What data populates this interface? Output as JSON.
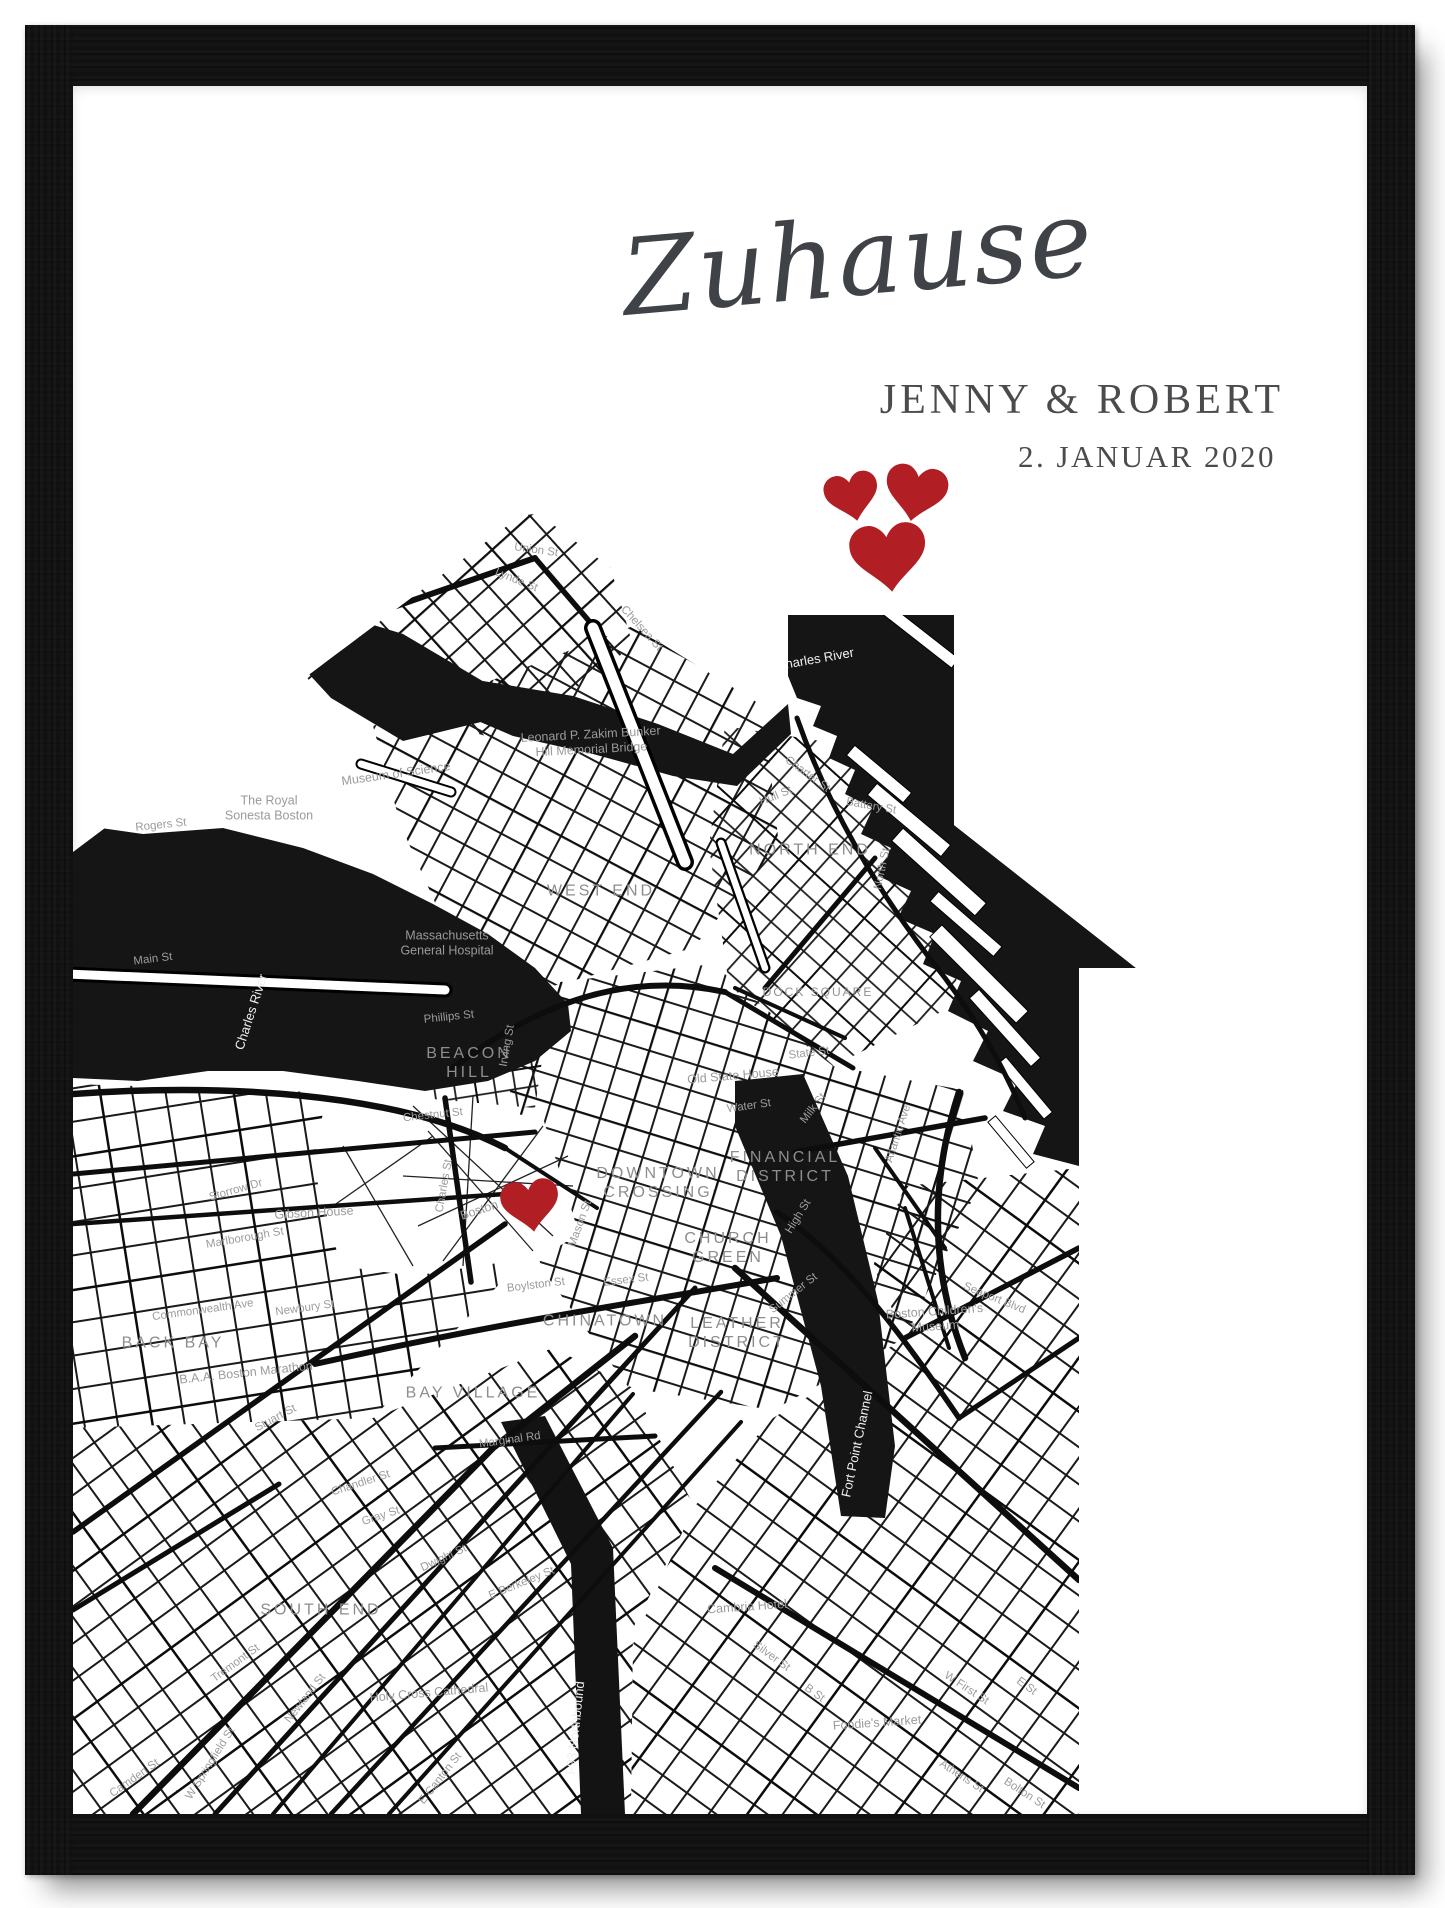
{
  "poster": {
    "title": "Zuhause",
    "names": "JENNY & ROBERT",
    "date": "2. JANUAR 2020"
  },
  "colors": {
    "heart_red": "#b11e24",
    "text_dark": "#4b4b4e",
    "title_gray": "#3f4246",
    "map_ink": "#141414",
    "label_gray": "#9a9a9a",
    "frame_black": "#121212"
  },
  "decor_hearts": [
    {
      "x": 780,
      "y": 412,
      "s": 54,
      "r": -12
    },
    {
      "x": 842,
      "y": 409,
      "s": 62,
      "r": 10
    },
    {
      "x": 816,
      "y": 473,
      "s": 76,
      "r": -6
    }
  ],
  "map": {
    "marker": {
      "x": 458,
      "y": 1121,
      "s": 58,
      "r": -8
    },
    "labels": [
      {
        "t": "NORTH END",
        "x": 737,
        "y": 765,
        "r": 0,
        "c": "nb"
      },
      {
        "t": "WEST END",
        "x": 528,
        "y": 806,
        "r": 0,
        "c": "nb"
      },
      {
        "t": "BEACON\nHILL",
        "x": 396,
        "y": 978,
        "r": 0,
        "c": "nb"
      },
      {
        "t": "DOWNTOWN\nCROSSING",
        "x": 585,
        "y": 1098,
        "r": 0,
        "c": "nb"
      },
      {
        "t": "FINANCIAL\nDISTRICT",
        "x": 712,
        "y": 1082,
        "r": 0,
        "c": "nb"
      },
      {
        "t": "CHURCH\nGREEN",
        "x": 655,
        "y": 1163,
        "r": 0,
        "c": "nb"
      },
      {
        "t": "CHINATOWN",
        "x": 532,
        "y": 1236,
        "r": 0,
        "c": "nb"
      },
      {
        "t": "LEATHER\nDISTRICT",
        "x": 664,
        "y": 1248,
        "r": 0,
        "c": "nb"
      },
      {
        "t": "BACK BAY",
        "x": 100,
        "y": 1258,
        "r": 0,
        "c": "nb"
      },
      {
        "t": "BAY VILLAGE",
        "x": 400,
        "y": 1308,
        "r": 0,
        "c": "nb"
      },
      {
        "t": "SOUTH END",
        "x": 248,
        "y": 1525,
        "r": 0,
        "c": "nb"
      },
      {
        "t": "DOCK SQUARE",
        "x": 745,
        "y": 906,
        "r": 0,
        "c": "nbs"
      },
      {
        "t": "Museum of Science",
        "x": 323,
        "y": 688,
        "r": -8,
        "c": "poi"
      },
      {
        "t": "The Royal\nSonesta Boston",
        "x": 196,
        "y": 722,
        "r": 0,
        "c": "poi"
      },
      {
        "t": "Massachusetts\nGeneral Hospital",
        "x": 374,
        "y": 857,
        "r": 0,
        "c": "poi"
      },
      {
        "t": "Leonard P. Zakim Bunker\nHill Memorial Bridge",
        "x": 518,
        "y": 656,
        "r": -3,
        "c": "poi"
      },
      {
        "t": "Old State House",
        "x": 660,
        "y": 990,
        "r": -5,
        "c": "poi"
      },
      {
        "t": "Gibson House",
        "x": 241,
        "y": 1127,
        "r": -3,
        "c": "poi"
      },
      {
        "t": "B.A.A. Boston Marathon",
        "x": 173,
        "y": 1287,
        "r": -6,
        "c": "poi"
      },
      {
        "t": "Boston Common",
        "x": 432,
        "y": 1116,
        "r": -18,
        "c": "poi"
      },
      {
        "t": "Holy Cross Cathedral",
        "x": 356,
        "y": 1607,
        "r": -5,
        "c": "poi"
      },
      {
        "t": "Cambria Hotel",
        "x": 674,
        "y": 1521,
        "r": -4,
        "c": "poi"
      },
      {
        "t": "Foodie's Market",
        "x": 804,
        "y": 1637,
        "r": -4,
        "c": "poi"
      },
      {
        "t": "Boston Children's\nMuseum",
        "x": 862,
        "y": 1233,
        "r": -4,
        "c": "poi"
      },
      {
        "t": "Rogers St",
        "x": 88,
        "y": 740,
        "r": -6,
        "c": "st"
      },
      {
        "t": "Main St",
        "x": 80,
        "y": 874,
        "r": -7,
        "c": "st"
      },
      {
        "t": "Phillips St",
        "x": 376,
        "y": 932,
        "r": -6,
        "c": "st"
      },
      {
        "t": "Irving St",
        "x": 435,
        "y": 960,
        "r": -80,
        "c": "st"
      },
      {
        "t": "Chestnut St",
        "x": 360,
        "y": 1030,
        "r": -6,
        "c": "st"
      },
      {
        "t": "Charles St",
        "x": 372,
        "y": 1100,
        "r": -80,
        "c": "st"
      },
      {
        "t": "Storrow Dr",
        "x": 163,
        "y": 1105,
        "r": -16,
        "c": "st"
      },
      {
        "t": "Marlborough St",
        "x": 172,
        "y": 1153,
        "r": -10,
        "c": "st"
      },
      {
        "t": "Commonwealth Ave",
        "x": 130,
        "y": 1225,
        "r": -8,
        "c": "st"
      },
      {
        "t": "Newbury St",
        "x": 232,
        "y": 1223,
        "r": -8,
        "c": "st"
      },
      {
        "t": "Stuart St",
        "x": 203,
        "y": 1333,
        "r": -28,
        "c": "st"
      },
      {
        "t": "Marginal Rd",
        "x": 437,
        "y": 1355,
        "r": -8,
        "c": "st"
      },
      {
        "t": "Chandler St",
        "x": 288,
        "y": 1398,
        "r": -18,
        "c": "st"
      },
      {
        "t": "Gray St",
        "x": 308,
        "y": 1431,
        "r": -18,
        "c": "st"
      },
      {
        "t": "Dwight St",
        "x": 371,
        "y": 1473,
        "r": -25,
        "c": "st"
      },
      {
        "t": "E Berkeley St",
        "x": 449,
        "y": 1498,
        "r": -22,
        "c": "st"
      },
      {
        "t": "Tremont St",
        "x": 163,
        "y": 1578,
        "r": -36,
        "c": "st"
      },
      {
        "t": "Newland St",
        "x": 233,
        "y": 1613,
        "r": -52,
        "c": "st"
      },
      {
        "t": "W Springfield St",
        "x": 138,
        "y": 1678,
        "r": -58,
        "c": "st"
      },
      {
        "t": "Camden St",
        "x": 62,
        "y": 1693,
        "r": -35,
        "c": "st"
      },
      {
        "t": "E Canton St",
        "x": 368,
        "y": 1693,
        "r": -52,
        "c": "st"
      },
      {
        "t": "Boylston St",
        "x": 463,
        "y": 1200,
        "r": -7,
        "c": "st"
      },
      {
        "t": "Essex St",
        "x": 553,
        "y": 1195,
        "r": -7,
        "c": "st"
      },
      {
        "t": "Mason St",
        "x": 508,
        "y": 1138,
        "r": -70,
        "c": "st"
      },
      {
        "t": "Lynde St",
        "x": 443,
        "y": 495,
        "r": 22,
        "c": "st"
      },
      {
        "t": "Union St",
        "x": 463,
        "y": 465,
        "r": 8,
        "c": "st"
      },
      {
        "t": "Chelsea St",
        "x": 568,
        "y": 543,
        "r": 48,
        "c": "st"
      },
      {
        "t": "Hull St",
        "x": 703,
        "y": 711,
        "r": -22,
        "c": "st"
      },
      {
        "t": "Charter St",
        "x": 734,
        "y": 689,
        "r": 36,
        "c": "st"
      },
      {
        "t": "Battery St",
        "x": 798,
        "y": 721,
        "r": 10,
        "c": "st"
      },
      {
        "t": "North St",
        "x": 810,
        "y": 783,
        "r": -78,
        "c": "st"
      },
      {
        "t": "State St",
        "x": 736,
        "y": 968,
        "r": -7,
        "c": "st"
      },
      {
        "t": "Water St",
        "x": 676,
        "y": 1021,
        "r": -8,
        "c": "st"
      },
      {
        "t": "Milk St",
        "x": 741,
        "y": 1023,
        "r": -52,
        "c": "st"
      },
      {
        "t": "High St",
        "x": 726,
        "y": 1131,
        "r": -58,
        "c": "st"
      },
      {
        "t": "Summer St",
        "x": 721,
        "y": 1208,
        "r": -38,
        "c": "st"
      },
      {
        "t": "Atlantic Ave",
        "x": 826,
        "y": 1048,
        "r": -72,
        "c": "st"
      },
      {
        "t": "Seaport Blvd",
        "x": 921,
        "y": 1213,
        "r": 22,
        "c": "st"
      },
      {
        "t": "W First St",
        "x": 893,
        "y": 1603,
        "r": 33,
        "c": "st"
      },
      {
        "t": "Athens St",
        "x": 888,
        "y": 1691,
        "r": 33,
        "c": "st"
      },
      {
        "t": "Bolton St",
        "x": 951,
        "y": 1708,
        "r": 33,
        "c": "st"
      },
      {
        "t": "Silver St",
        "x": 698,
        "y": 1571,
        "r": 36,
        "c": "st"
      },
      {
        "t": "B St",
        "x": 741,
        "y": 1608,
        "r": 36,
        "c": "st"
      },
      {
        "t": "E St",
        "x": 953,
        "y": 1601,
        "r": 36,
        "c": "st"
      },
      {
        "t": "Charles River",
        "x": 178,
        "y": 926,
        "r": -72,
        "c": "water"
      },
      {
        "t": "Charles River",
        "x": 742,
        "y": 573,
        "r": -10,
        "c": "water"
      },
      {
        "t": "Fort Point Channel",
        "x": 784,
        "y": 1358,
        "r": -78,
        "c": "water"
      },
      {
        "t": "I-93 Northbound",
        "x": 502,
        "y": 1642,
        "r": -84,
        "c": "water"
      }
    ]
  }
}
